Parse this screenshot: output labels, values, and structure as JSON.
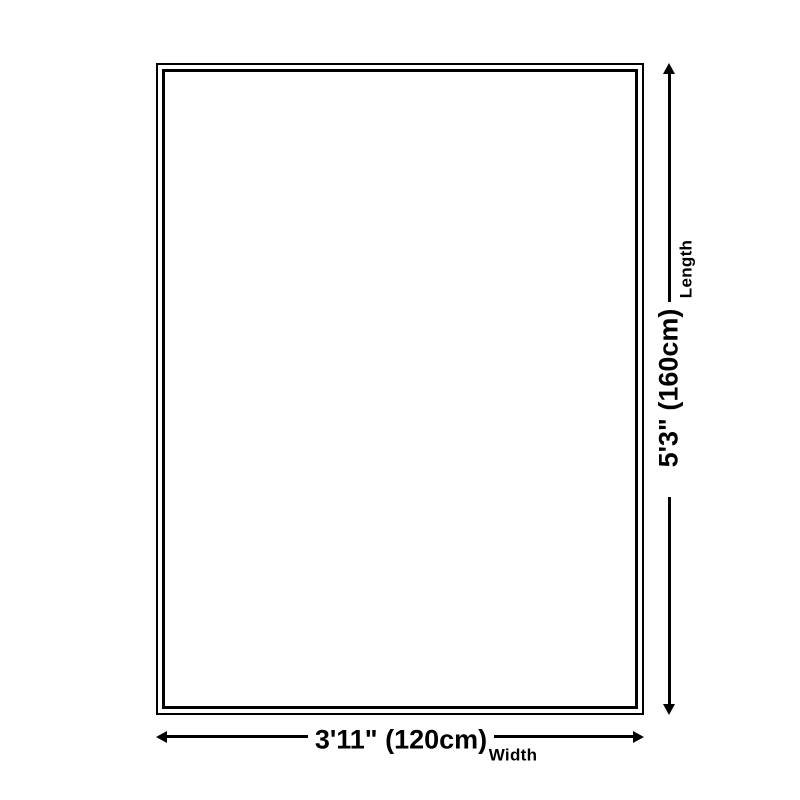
{
  "colors": {
    "line": "#000000",
    "text": "#000000",
    "background": "#ffffff"
  },
  "diagram": {
    "length": {
      "label": "Length",
      "value": "5'3\" (160cm)"
    },
    "width": {
      "label": "Width",
      "value": "3'11\" (120cm)"
    }
  }
}
